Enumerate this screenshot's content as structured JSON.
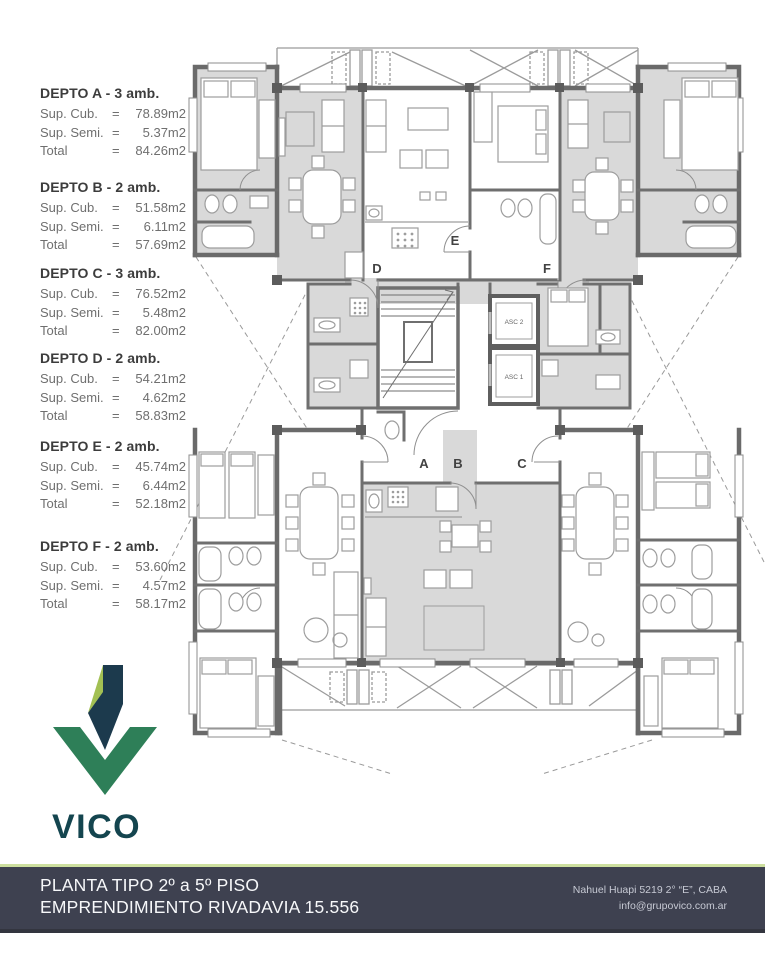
{
  "sidebar": {
    "equals": "=",
    "apartments": [
      {
        "title": "DEPTO A - 3 amb.",
        "rows": [
          {
            "label": "Sup. Cub.",
            "value": "78.89m2"
          },
          {
            "label": "Sup. Semi.",
            "value": "5.37m2"
          },
          {
            "label": "Total",
            "value": "84.26m2"
          }
        ]
      },
      {
        "title": "DEPTO B - 2 amb.",
        "rows": [
          {
            "label": "Sup. Cub.",
            "value": "51.58m2"
          },
          {
            "label": "Sup. Semi.",
            "value": "6.11m2"
          },
          {
            "label": "Total",
            "value": "57.69m2"
          }
        ]
      },
      {
        "title": "DEPTO C - 3 amb.",
        "rows": [
          {
            "label": "Sup. Cub.",
            "value": "76.52m2"
          },
          {
            "label": "Sup. Semi.",
            "value": "5.48m2"
          },
          {
            "label": "Total",
            "value": "82.00m2"
          }
        ]
      },
      {
        "title": "DEPTO D - 2 amb.",
        "rows": [
          {
            "label": "Sup. Cub.",
            "value": "54.21m2"
          },
          {
            "label": "Sup. Semi.",
            "value": "4.62m2"
          },
          {
            "label": "Total",
            "value": "58.83m2"
          }
        ]
      },
      {
        "title": "DEPTO E - 2 amb.",
        "rows": [
          {
            "label": "Sup. Cub.",
            "value": "45.74m2"
          },
          {
            "label": "Sup. Semi.",
            "value": "6.44m2"
          },
          {
            "label": "Total",
            "value": "52.18m2"
          }
        ]
      },
      {
        "title": "DEPTO F - 2 amb.",
        "rows": [
          {
            "label": "Sup. Cub.",
            "value": "53.60m2"
          },
          {
            "label": "Sup. Semi.",
            "value": "4.57m2"
          },
          {
            "label": "Total",
            "value": "58.17m2"
          }
        ]
      }
    ]
  },
  "plan": {
    "unit_labels": {
      "a": "A",
      "b": "B",
      "c": "C",
      "d": "D",
      "e": "E",
      "f": "F"
    },
    "elevator_1": "ASC 1",
    "elevator_2": "ASC 2"
  },
  "logo": {
    "brand": "VICO"
  },
  "footer": {
    "title_line1": "PLANTA TIPO 2º a 5º PISO",
    "title_line2": "EMPRENDIMIENTO RIVADAVIA 15.556",
    "address": "Nahuel Huapi 5219 2° “E”, CABA",
    "email": "info@grupovico.com.ar"
  },
  "colors": {
    "footer_bg": "#3e4150",
    "accent_line": "#cddf9f",
    "logo_teal": "#14454f",
    "logo_green": "#2e7f58",
    "logo_navy": "#1c3a4d",
    "logo_lime": "#a2c053",
    "wall_gray": "#6a6a6a",
    "room_fill": "#d9d9d9"
  }
}
